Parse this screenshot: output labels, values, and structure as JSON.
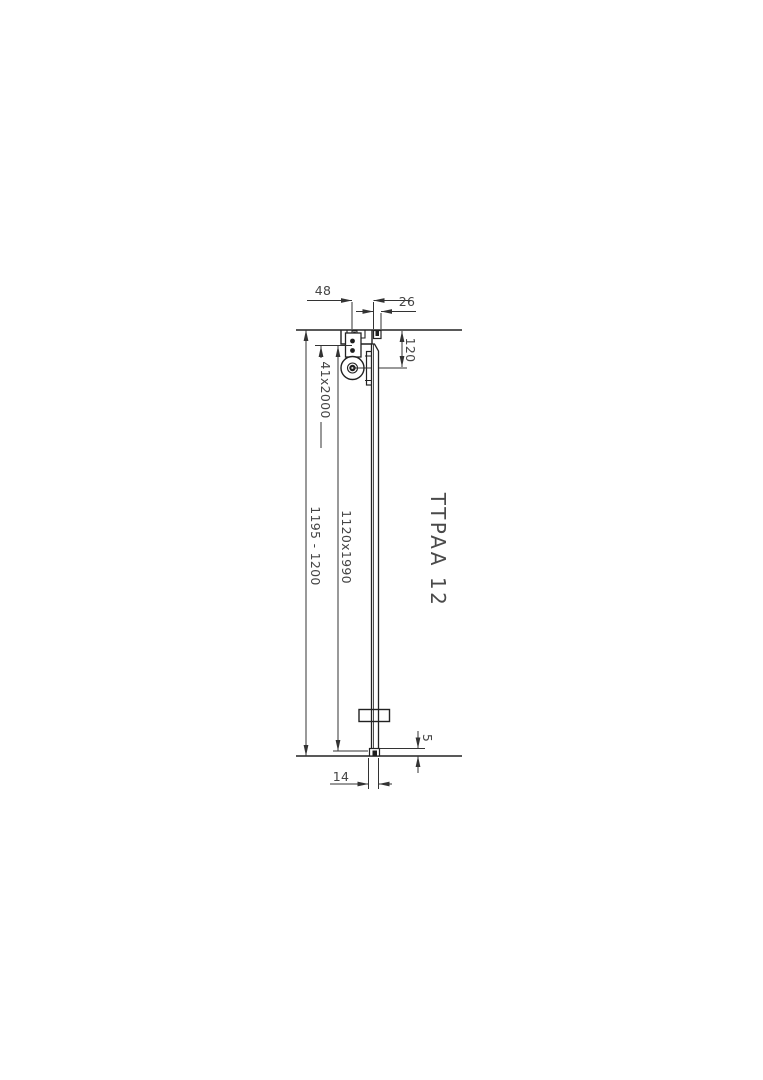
{
  "title": {
    "text": "TTPAA 12"
  },
  "dimensions": {
    "track_width": "48",
    "side_offset": "26",
    "hanger_height": "120",
    "profile_size": "41x2000",
    "overall_height": "1195 - 1200",
    "panel_size": "1120x1990",
    "floor_clearance": "5",
    "panel_thickness": "14"
  },
  "colors": {
    "background": "#ffffff",
    "object_line": "#222222",
    "dimension_line": "#333333",
    "label_text": "#454545"
  }
}
